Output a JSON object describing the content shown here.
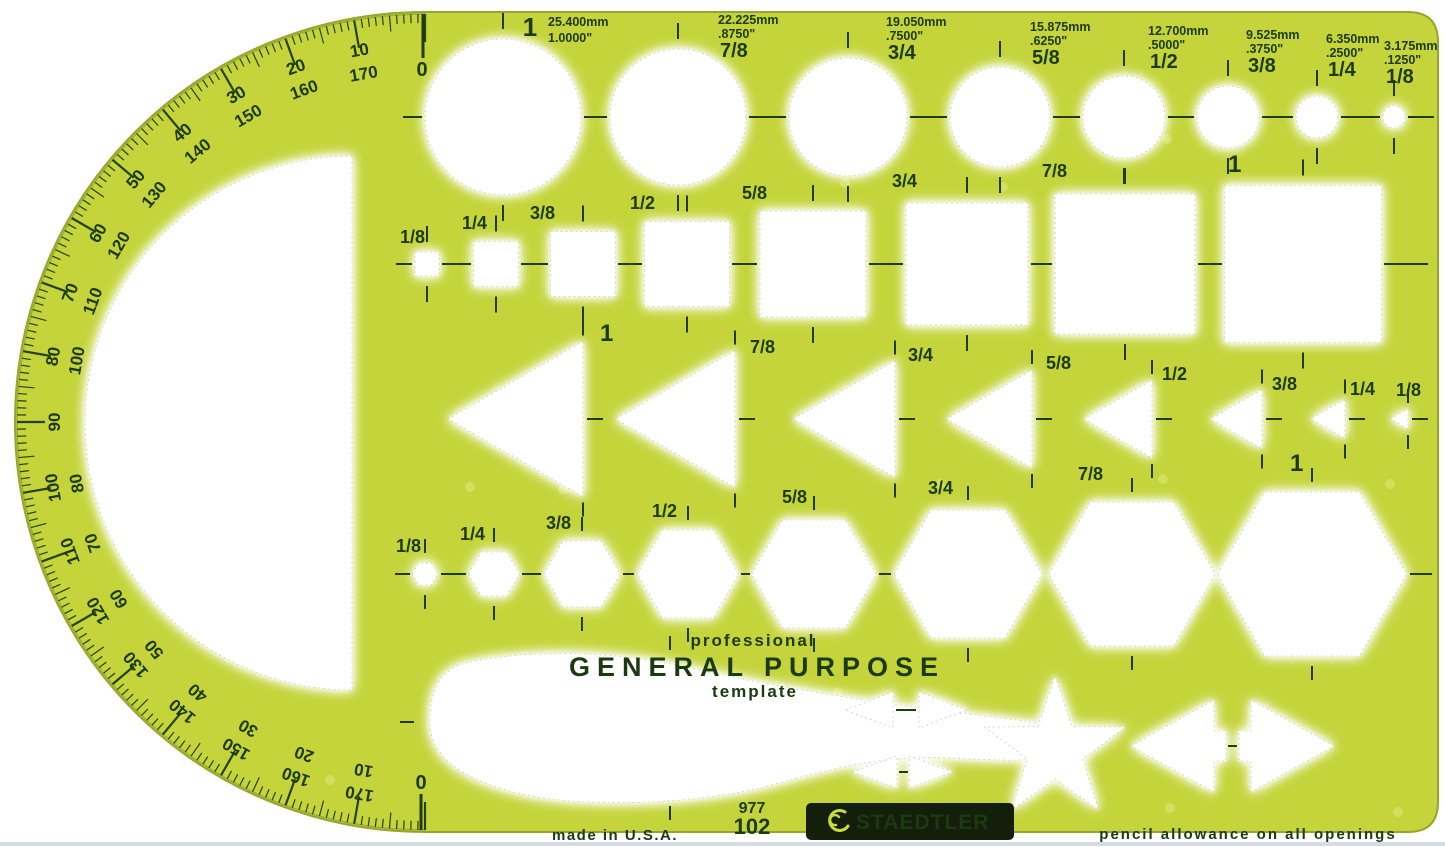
{
  "texts": {
    "professional": "professional",
    "general_purpose": "GENERAL PURPOSE",
    "template": "template",
    "model_top": "977",
    "model_bottom": "102",
    "made_in": "made in U.S.A.",
    "brand": "STAEDTLER",
    "pencil_note": "pencil allowance on all openings"
  },
  "circles": [
    {
      "mm": "25.400mm",
      "inch": "1.0000\"",
      "fraction": "1"
    },
    {
      "mm": "22.225mm",
      "inch": ".8750\"",
      "fraction": "7/8"
    },
    {
      "mm": "19.050mm",
      "inch": ".7500\"",
      "fraction": "3/4"
    },
    {
      "mm": "15.875mm",
      "inch": ".6250\"",
      "fraction": "5/8"
    },
    {
      "mm": "12.700mm",
      "inch": ".5000\"",
      "fraction": "1/2"
    },
    {
      "mm": "9.525mm",
      "inch": ".3750\"",
      "fraction": "3/8"
    },
    {
      "mm": "6.350mm",
      "inch": ".2500\"",
      "fraction": "1/4"
    },
    {
      "mm": "3.175mm",
      "inch": ".1250\"",
      "fraction": "1/8"
    }
  ],
  "squares": [
    "1/8",
    "1/4",
    "3/8",
    "1/2",
    "5/8",
    "3/4",
    "7/8",
    "1"
  ],
  "triangles": [
    "1",
    "7/8",
    "3/4",
    "5/8",
    "1/2",
    "3/8",
    "1/4",
    "1/8"
  ],
  "hexagons": [
    "1/8",
    "1/4",
    "3/8",
    "1/2",
    "5/8",
    "3/4",
    "7/8",
    "1"
  ],
  "protractor": {
    "zero_top": "0",
    "zero_bottom": "0",
    "pairs": [
      {
        "outer": "10",
        "inner": "170"
      },
      {
        "outer": "20",
        "inner": "160"
      },
      {
        "outer": "30",
        "inner": "150"
      },
      {
        "outer": "40",
        "inner": "140"
      },
      {
        "outer": "50",
        "inner": "130"
      },
      {
        "outer": "60",
        "inner": "120"
      },
      {
        "outer": "70",
        "inner": "110"
      },
      {
        "outer": "80",
        "inner": "100"
      },
      {
        "outer": "90",
        "inner": null
      },
      {
        "outer": "100",
        "inner": "80"
      },
      {
        "outer": "110",
        "inner": "70"
      },
      {
        "outer": "120",
        "inner": "60"
      },
      {
        "outer": "130",
        "inner": "50"
      },
      {
        "outer": "140",
        "inner": "40"
      },
      {
        "outer": "150",
        "inner": "30"
      },
      {
        "outer": "160",
        "inner": "20"
      },
      {
        "outer": "170",
        "inner": "10"
      }
    ]
  },
  "colors": {
    "body": "#c4d43a",
    "edge": "#96a52e",
    "ink": "#1b3a0f",
    "logo_box": "#131f0b",
    "logo_text": "#c9da3d",
    "scan_line": "#c7d0d9"
  }
}
